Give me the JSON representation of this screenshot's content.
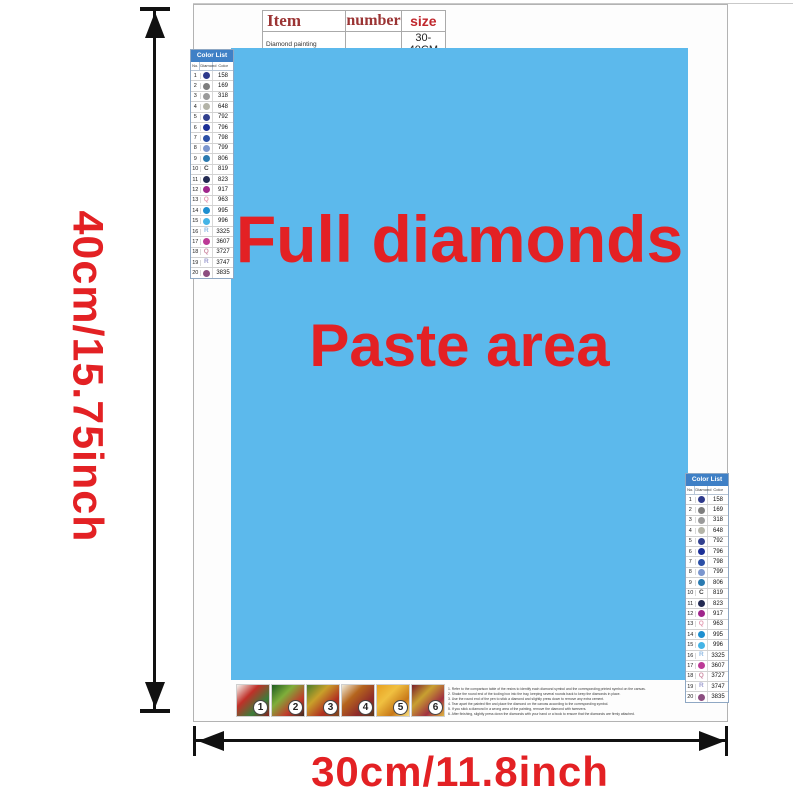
{
  "colors": {
    "accent_red": "#e32124",
    "paste_blue": "#5cb9ec",
    "list_header_blue": "#3f80c6",
    "table_header_red": "#9b3434",
    "size_red": "#c0272d"
  },
  "dimensions": {
    "height_label": "40cm/15.75inch",
    "width_label": "30cm/11.8inch"
  },
  "spec_table": {
    "headers": [
      "Item",
      "number",
      "size"
    ],
    "row": {
      "item": "Diamond painting",
      "number": "",
      "size": "30-40CM"
    }
  },
  "paste_area": {
    "line1": "Full diamonds",
    "line2": "Paste area"
  },
  "color_list": {
    "title": "Color List",
    "columns": [
      "No.",
      "Diamond",
      "Color"
    ],
    "rows": [
      {
        "no": "1",
        "symbol": "dot",
        "letter": "",
        "color": "#2e3a8c",
        "code": "158"
      },
      {
        "no": "2",
        "symbol": "dot",
        "letter": "",
        "color": "#7d7d7d",
        "code": "169"
      },
      {
        "no": "3",
        "symbol": "dot",
        "letter": "",
        "color": "#9a9a9a",
        "code": "318"
      },
      {
        "no": "4",
        "symbol": "dot",
        "letter": "",
        "color": "#b4b4a8",
        "code": "648"
      },
      {
        "no": "5",
        "symbol": "dot",
        "letter": "",
        "color": "#32408e",
        "code": "792"
      },
      {
        "no": "6",
        "symbol": "dot",
        "letter": "",
        "color": "#1c2f96",
        "code": "796"
      },
      {
        "no": "7",
        "symbol": "dot",
        "letter": "",
        "color": "#2b4fa6",
        "code": "798"
      },
      {
        "no": "8",
        "symbol": "dot",
        "letter": "",
        "color": "#7b96ce",
        "code": "799"
      },
      {
        "no": "9",
        "symbol": "dot",
        "letter": "",
        "color": "#2a7ab0",
        "code": "806"
      },
      {
        "no": "10",
        "symbol": "letter",
        "letter": "C",
        "color": "#444444",
        "code": "819"
      },
      {
        "no": "11",
        "symbol": "dot",
        "letter": "",
        "color": "#232a52",
        "code": "823"
      },
      {
        "no": "12",
        "symbol": "dot",
        "letter": "",
        "color": "#a0268c",
        "code": "917"
      },
      {
        "no": "13",
        "symbol": "letter",
        "letter": "Q",
        "color": "#e49cb2",
        "code": "963"
      },
      {
        "no": "14",
        "symbol": "dot",
        "letter": "",
        "color": "#1e8fd0",
        "code": "995"
      },
      {
        "no": "15",
        "symbol": "dot",
        "letter": "",
        "color": "#45b4e6",
        "code": "996"
      },
      {
        "no": "16",
        "symbol": "letter",
        "letter": "R",
        "color": "#92bce4",
        "code": "3325"
      },
      {
        "no": "17",
        "symbol": "dot",
        "letter": "",
        "color": "#bc3a96",
        "code": "3607"
      },
      {
        "no": "18",
        "symbol": "letter",
        "letter": "Q",
        "color": "#cf8fa6",
        "code": "3727"
      },
      {
        "no": "19",
        "symbol": "letter",
        "letter": "R",
        "color": "#9f9fd0",
        "code": "3747"
      },
      {
        "no": "20",
        "symbol": "dot",
        "letter": "",
        "color": "#8c4e80",
        "code": "3835"
      }
    ]
  },
  "thumbnails": [
    {
      "number": "1",
      "palette": [
        "#f5f5f0",
        "#c03028",
        "#3a7d3a",
        "#8a1f1f"
      ]
    },
    {
      "number": "2",
      "palette": [
        "#1f5c20",
        "#7fae3a",
        "#c0392b",
        "#3d2b1f"
      ]
    },
    {
      "number": "3",
      "palette": [
        "#4a7d2a",
        "#c8a02a",
        "#b03020",
        "#7a4a20"
      ]
    },
    {
      "number": "4",
      "palette": [
        "#f0ead8",
        "#b5651d",
        "#8f2a2a",
        "#5a3a1a"
      ]
    },
    {
      "number": "5",
      "palette": [
        "#e8a020",
        "#f0c040",
        "#c87818",
        "#f8e080"
      ]
    },
    {
      "number": "6",
      "palette": [
        "#7a1f2a",
        "#c8a030",
        "#a03040",
        "#e0b840"
      ]
    }
  ],
  "instructions": {
    "lines": [
      "1. Refer to the comparison table of the resins to identify each diamond symbol and the corresponding printed symbol on the canvas.",
      "2. Shake the round end of the tooling box into the tray, keeping several rounds back to keep the diamonds in place.",
      "3. Use the round end of the pen to stick a diamond and slightly press down to remove any extra cement.",
      "4. Tear apart the painted film and place the diamond on the canvas according to the corresponding symbol.",
      "5. If you stick a diamond in a wrong area of the painting, remove the diamond with tweezers.",
      "6. After finishing, slightly press down the diamonds with your hand or a book to ensure that the diamonds are firmly attached."
    ]
  }
}
